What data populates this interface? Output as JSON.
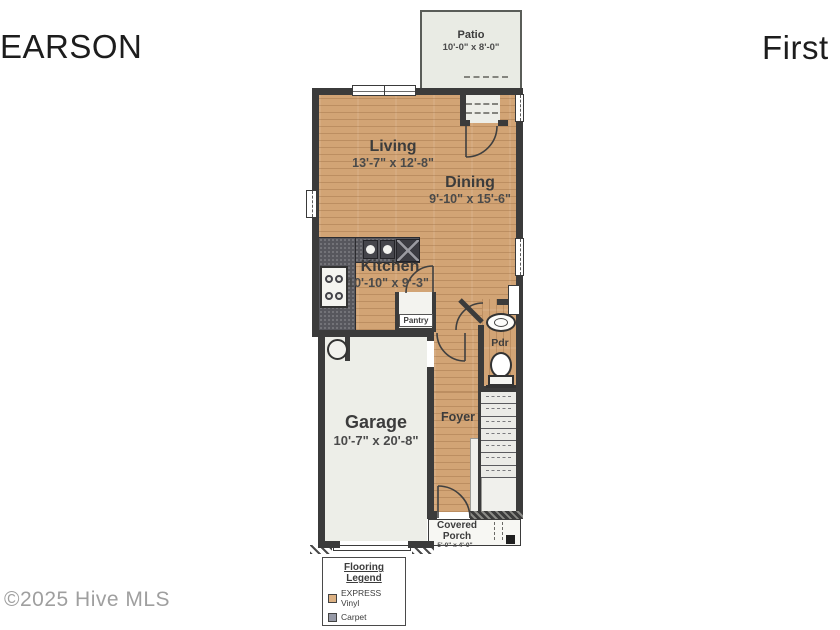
{
  "header": {
    "title_left": "EARSON",
    "title_right": "First"
  },
  "watermark": "©2025 Hive MLS",
  "rooms": {
    "patio": {
      "name": "Patio",
      "dims": "10'-0\" x 8'-0\""
    },
    "living": {
      "name": "Living",
      "dims": "13'-7\" x 12'-8\""
    },
    "dining": {
      "name": "Dining",
      "dims": "9'-10\" x 15'-6\""
    },
    "kitchen": {
      "name": "Kitchen",
      "dims": "10'-10\" x 9'-3\""
    },
    "pantry": {
      "name": "Pantry"
    },
    "powder": {
      "name": "Pdr"
    },
    "foyer": {
      "name": "Foyer"
    },
    "garage": {
      "name": "Garage",
      "dims": "10'-7\" x 20'-8\""
    },
    "porch": {
      "line1": "Covered",
      "line2": "Porch",
      "dims": "5'-0\" x 4'-0\""
    }
  },
  "legend": {
    "title1": "Flooring",
    "title2": "Legend",
    "items": [
      {
        "label": "EXPRESS Vinyl",
        "swatch": "#dcb183"
      },
      {
        "label": "Carpet",
        "swatch": "#979aa7"
      }
    ]
  },
  "colors": {
    "wall": "#3b3b3b",
    "wood": "#d2a475",
    "light_area": "#edeee8",
    "counter": "#57575d"
  }
}
